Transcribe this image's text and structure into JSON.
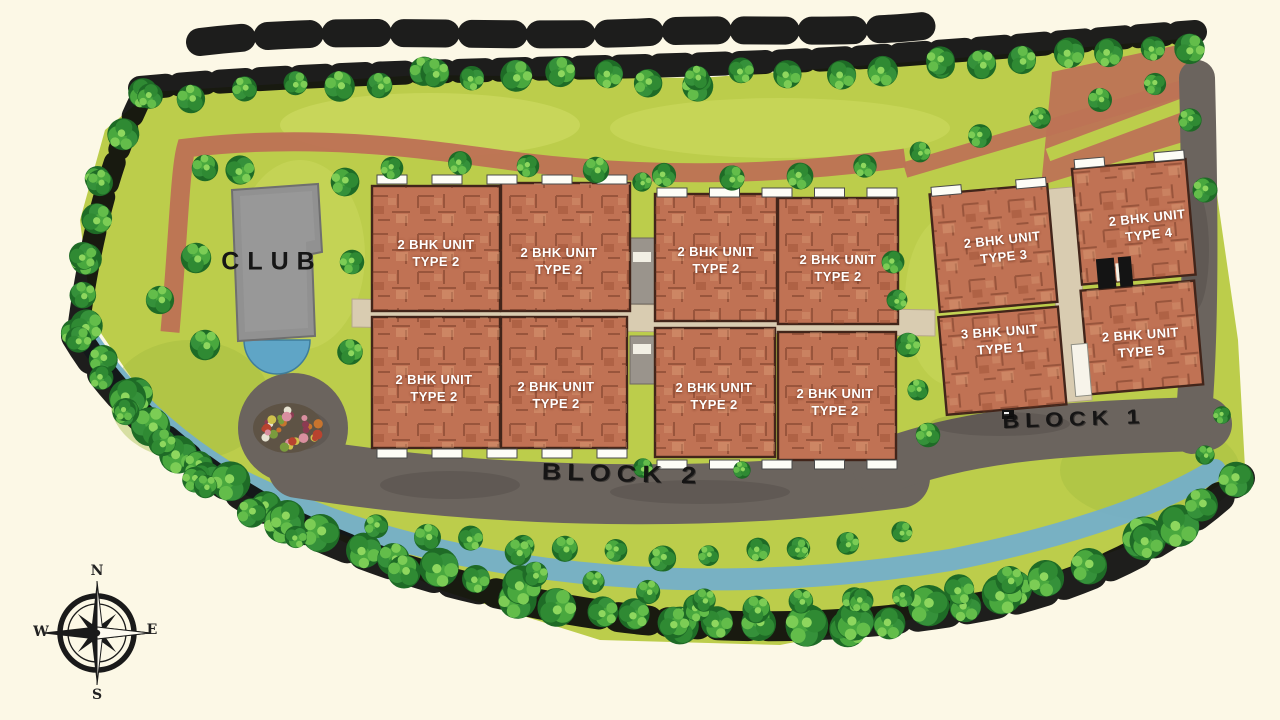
{
  "club": {
    "label": "CLUB"
  },
  "roads": {
    "block1_label": "BLOCK 1",
    "block2_label": "BLOCK 2"
  },
  "block2": {
    "units": [
      {
        "line1": "2 BHK UNIT",
        "line2": "TYPE 2"
      },
      {
        "line1": "2 BHK UNIT",
        "line2": "TYPE 2"
      },
      {
        "line1": "2 BHK UNIT",
        "line2": "TYPE 2"
      },
      {
        "line1": "2 BHK UNIT",
        "line2": "TYPE 2"
      },
      {
        "line1": "2 BHK UNIT",
        "line2": "TYPE 2"
      },
      {
        "line1": "2 BHK UNIT",
        "line2": "TYPE 2"
      },
      {
        "line1": "2 BHK UNIT",
        "line2": "TYPE 2"
      },
      {
        "line1": "2 BHK UNIT",
        "line2": "TYPE 2"
      }
    ]
  },
  "block1": {
    "units": [
      {
        "line1": "2 BHK UNIT",
        "line2": "TYPE 3"
      },
      {
        "line1": "2 BHK UNIT",
        "line2": "TYPE 4"
      },
      {
        "line1": "3 BHK UNIT",
        "line2": "TYPE 1"
      },
      {
        "line1": "2 BHK UNIT",
        "line2": "TYPE 5"
      }
    ]
  },
  "compass": {
    "n": "N",
    "e": "E",
    "s": "S",
    "w": "W"
  },
  "colors": {
    "background": "#fcf8e6",
    "lawn": "#bccd4b",
    "lawn_light": "#d4e06a",
    "lawn_dark": "#9fba3f",
    "tree_green": "#2f8a33",
    "building": "#c07254",
    "building_line": "#42251a",
    "road": "#6b645e",
    "path": "#bd7355",
    "corridor": "#d9ccb1",
    "water": "#74afc9",
    "pool": "#5fa5c6",
    "club_gray": "#919191"
  }
}
